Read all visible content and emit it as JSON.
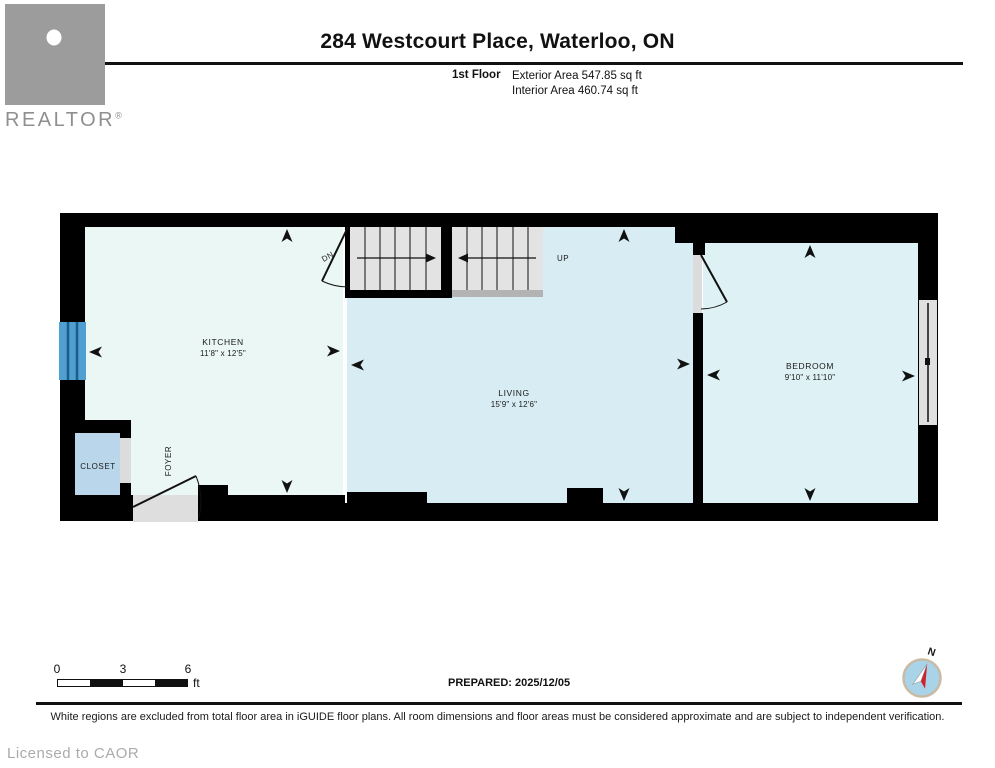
{
  "header": {
    "title": "284 Westcourt Place, Waterloo, ON",
    "floor_label": "1st Floor",
    "exterior_area": "Exterior Area 547.85 sq ft",
    "interior_area": "Interior Area 460.74 sq ft",
    "realtor_logo_text": "REALTOR",
    "registered_mark": "®"
  },
  "plan": {
    "rooms": {
      "kitchen": {
        "name": "KITCHEN",
        "dims": "11'8\" x 12'5\""
      },
      "living": {
        "name": "LIVING",
        "dims": "15'9\" x 12'6\""
      },
      "bedroom": {
        "name": "BEDROOM",
        "dims": "9'10\" x 11'10\""
      },
      "closet": {
        "name": "CLOSET"
      },
      "foyer": {
        "name": "FOYER"
      }
    },
    "stairs": {
      "down_label": "DN",
      "up_label": "UP"
    },
    "colors": {
      "wall": "#000000",
      "kitchen_floor": "#eaf7f4",
      "living_floor": "#d8edf3",
      "bedroom_floor": "#def1f5",
      "closet_floor": "#b9d6ea",
      "window_blue": "#4f9fd0",
      "stair_tread": "#e3e3e3",
      "landing_gray": "#b3b3b3",
      "door_opening_gray": "#dcdcdc",
      "entry_landing_gray": "#dedede"
    }
  },
  "scale_bar": {
    "tick_0": "0",
    "tick_3": "3",
    "tick_6": "6",
    "unit": "ft"
  },
  "compass": {
    "north_label": "N",
    "ring_color": "#c9baa4",
    "face_color": "#a9d3e9",
    "needle_red": "#cf2128"
  },
  "footer": {
    "prepared": "PREPARED: 2025/12/05",
    "disclaimer": "White regions are excluded from total floor area in iGUIDE floor plans. All room dimensions and floor areas must be considered approximate and are subject to independent verification.",
    "license": "Licensed to CAOR"
  }
}
